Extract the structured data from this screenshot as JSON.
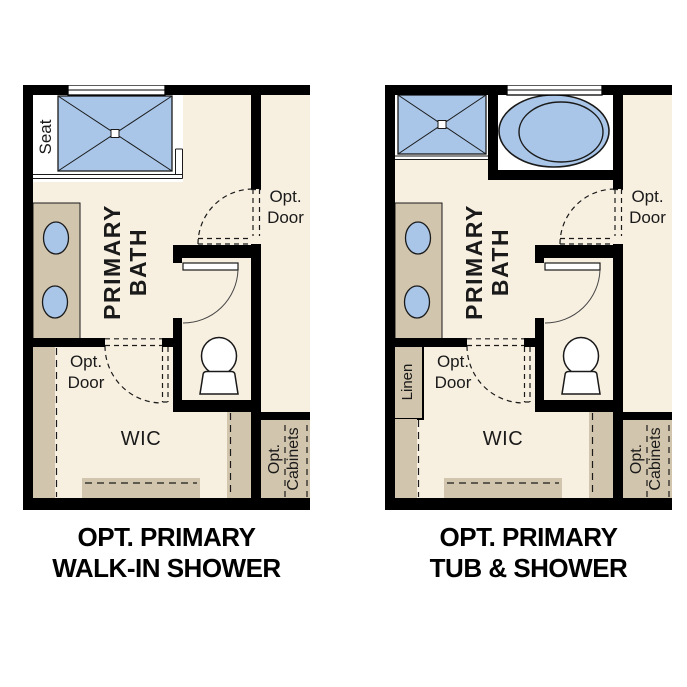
{
  "colors": {
    "floor_cream": "#f7efe0",
    "cabinet_tan": "#d2c5ad",
    "fixture_blue": "#a9c6e8",
    "wall_black": "#000000",
    "line_dark": "#1a1a1a"
  },
  "plans": [
    {
      "id": "opt-primary-walk-in-shower",
      "caption": {
        "line1": "OPT. PRIMARY",
        "line2": "WALK-IN SHOWER"
      },
      "labels": {
        "seat": "Seat",
        "room_line1": "PRIMARY",
        "room_line2": "BATH",
        "entry_door_line1": "Opt.",
        "entry_door_line2": "Door",
        "wic_door_line1": "Opt.",
        "wic_door_line2": "Door",
        "wic": "WIC",
        "cabinets_line1": "Opt.",
        "cabinets_line2": "Cabinets"
      }
    },
    {
      "id": "opt-primary-tub-and-shower",
      "caption": {
        "line1": "OPT. PRIMARY",
        "line2": "TUB & SHOWER"
      },
      "labels": {
        "linen": "Linen",
        "room_line1": "PRIMARY",
        "room_line2": "BATH",
        "entry_door_line1": "Opt.",
        "entry_door_line2": "Door",
        "wic_door_line1": "Opt.",
        "wic_door_line2": "Door",
        "wic": "WIC",
        "cabinets_line1": "Opt.",
        "cabinets_line2": "Cabinets"
      }
    }
  ]
}
